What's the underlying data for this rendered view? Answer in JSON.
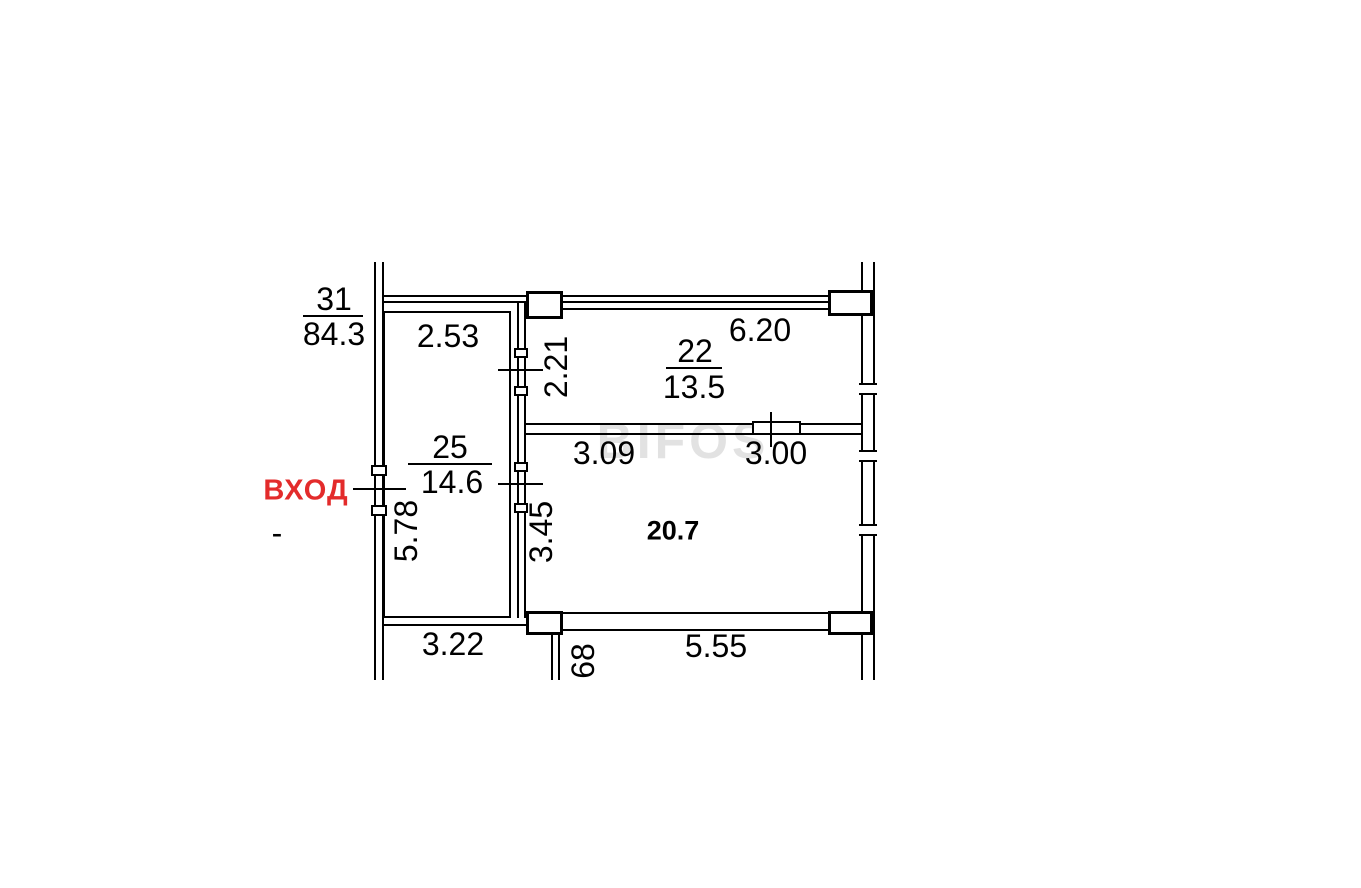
{
  "watermark": "BIFOS",
  "entrance": {
    "label": "ВХОД",
    "dash": "-"
  },
  "unit_total": {
    "number": "31",
    "area": "84.3"
  },
  "rooms": {
    "room25": {
      "number": "25",
      "area": "14.6"
    },
    "room22": {
      "number": "22",
      "area": "13.5"
    },
    "room20": {
      "area": "20.7"
    }
  },
  "dimensions": {
    "top_left": "2.53",
    "top_right": "6.20",
    "vert_2_21": "2.21",
    "mid_left": "3.09",
    "mid_right": "3.00",
    "vert_5_78": "5.78",
    "vert_3_45": "3.45",
    "bottom_left": "3.22",
    "vert_68": "68",
    "bottom_right": "5.55"
  },
  "colors": {
    "entrance_red": "#e32b2b",
    "line_black": "#000000",
    "watermark_gray": "#d0d0d0",
    "background": "#ffffff"
  }
}
